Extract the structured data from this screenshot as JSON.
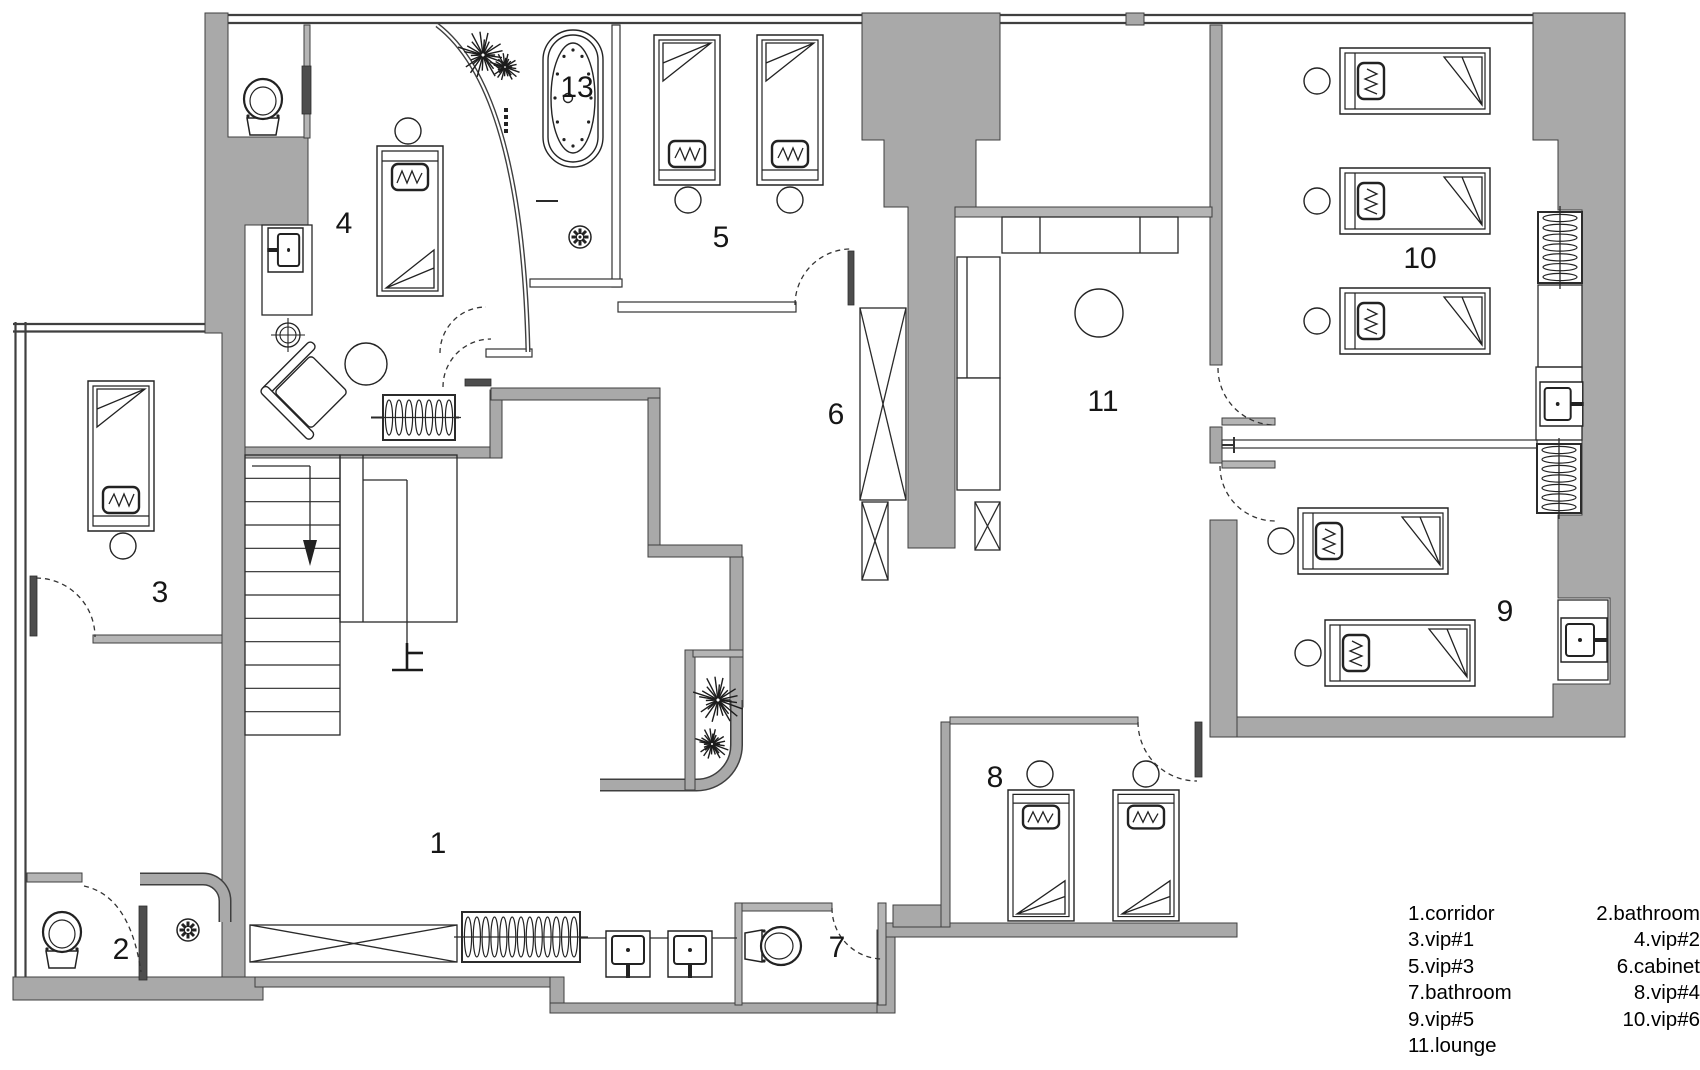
{
  "colors": {
    "wall": "#a9a9a9",
    "wall_light": "#b5b5b5",
    "ink": "#2a2a2a"
  },
  "rooms": {
    "r1": {
      "label": "1",
      "name": "corridor"
    },
    "r2": {
      "label": "2",
      "name": "bathroom"
    },
    "r3": {
      "label": "3",
      "name": "vip#1"
    },
    "r4": {
      "label": "4",
      "name": "vip#2"
    },
    "r5": {
      "label": "5",
      "name": "vip#3"
    },
    "r6": {
      "label": "6",
      "name": "cabinet"
    },
    "r7": {
      "label": "7",
      "name": "bathroom"
    },
    "r8": {
      "label": "8",
      "name": "vip#4"
    },
    "r9": {
      "label": "9",
      "name": "vip#5"
    },
    "r10": {
      "label": "10",
      "name": "vip#6"
    },
    "r11": {
      "label": "11",
      "name": "lounge"
    },
    "r13": {
      "label": "13"
    }
  },
  "annotations": {
    "stair_up": "上"
  },
  "legend": {
    "left": [
      "1.corridor",
      "3.vip#1",
      "5.vip#3",
      "7.bathroom",
      "9.vip#5",
      "11.lounge"
    ],
    "right": [
      "2.bathroom",
      "4.vip#2",
      "6.cabinet",
      "8.vip#4",
      "10.vip#6"
    ]
  }
}
